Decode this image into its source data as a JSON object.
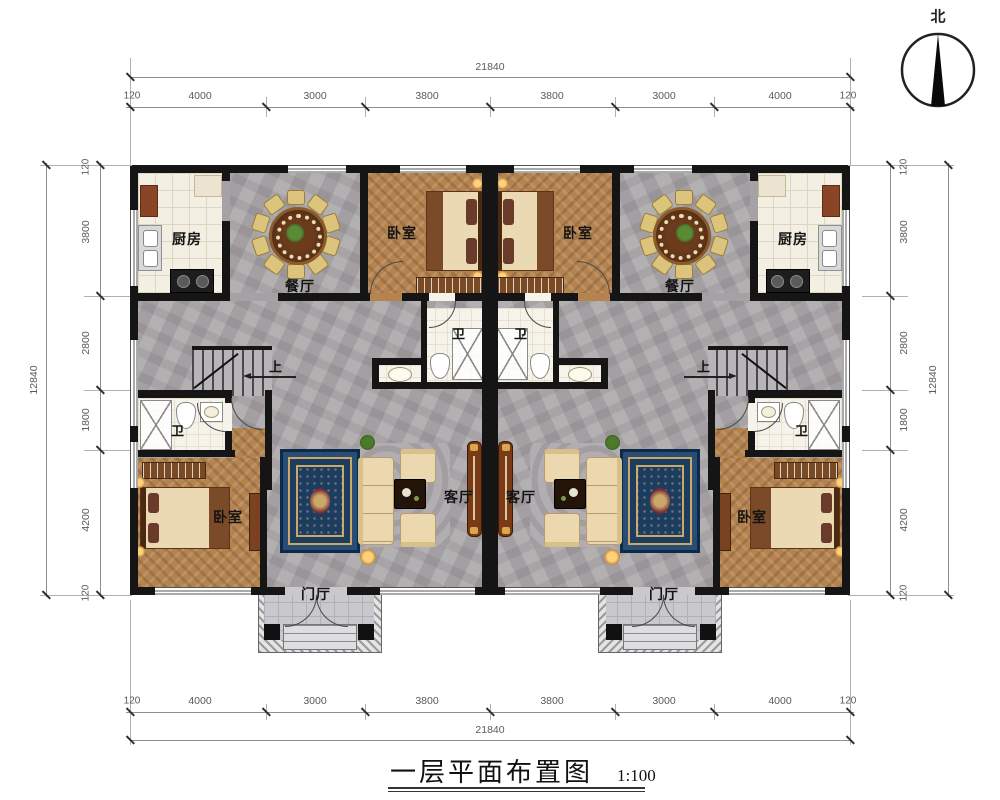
{
  "title": {
    "text": "一层平面布置图",
    "scale_label": "1:100"
  },
  "compass": {
    "north_label": "北"
  },
  "labels": {
    "kitchen": "厨房",
    "dining": "餐厅",
    "bedroom": "卧室",
    "bath": "卫",
    "living": "客厅",
    "foyer": "门厅",
    "stairs_up": "上"
  },
  "dimensions": {
    "top": {
      "total": "21840",
      "segments": [
        "120",
        "4000",
        "3000",
        "3800",
        "3800",
        "3000",
        "4000",
        "120"
      ]
    },
    "bottom": {
      "total": "21840",
      "segments": [
        "120",
        "4000",
        "3000",
        "3800",
        "3800",
        "3000",
        "4000",
        "120"
      ]
    },
    "left": {
      "total": "12840",
      "segments": [
        "120",
        "3800",
        "2800",
        "1800",
        "4200",
        "120"
      ]
    },
    "right": {
      "total": "12840",
      "segments": [
        "120",
        "3800",
        "2800",
        "1800",
        "4200",
        "120"
      ]
    }
  }
}
